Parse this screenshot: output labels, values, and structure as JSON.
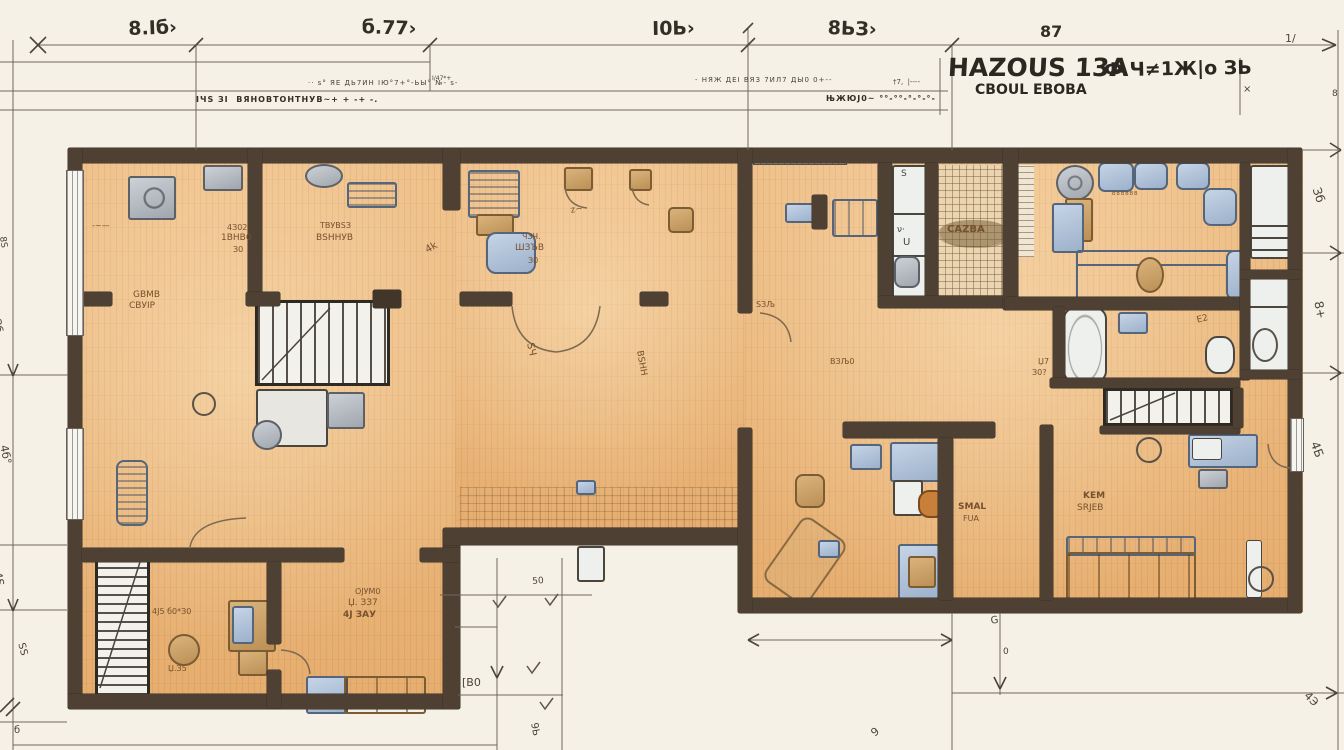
{
  "title_block": {
    "title": "HAZOUS 13A",
    "subtitle": "CBOUL EBOBA",
    "side_text": "Ф Ч≠1Ж|о ЗЬ"
  },
  "colors": {
    "paper": "#f5f1e6",
    "wall": "#4e4133",
    "floor": "#ecba80",
    "furniture_blue": "#a9bdd4",
    "furniture_tan": "#c9a06a",
    "fixture_white": "#eef0ee",
    "accent_orange": "#c87f3a"
  },
  "annotations": [
    {
      "n": "dim-top-1",
      "t": "8.Іб›",
      "x": 128,
      "y": 20,
      "s": 19,
      "r": -2,
      "c": "ink",
      "w": 700
    },
    {
      "n": "dim-top-2",
      "t": "б.77›",
      "x": 362,
      "y": 18,
      "s": 19,
      "r": 2,
      "c": "ink",
      "w": 700
    },
    {
      "n": "dim-top-3",
      "t": "І0Ь›",
      "x": 652,
      "y": 20,
      "s": 19,
      "r": -1,
      "c": "ink",
      "w": 700
    },
    {
      "n": "dim-top-4",
      "t": "8ЬЗ›",
      "x": 828,
      "y": 19,
      "s": 19,
      "r": 2,
      "c": "ink",
      "w": 700
    },
    {
      "n": "dim-top-5",
      "t": "87",
      "x": 1040,
      "y": 24,
      "s": 16,
      "c": "ink",
      "w": 700
    },
    {
      "n": "schedule-row-1",
      "t": "·· ѕ° ЯЕ ДЬ7ИН ІЮ°7+°-ЬЫ° №- ѕ-",
      "x": 308,
      "y": 80,
      "s": 7,
      "c": "dim",
      "ls": 1
    },
    {
      "n": "schedule-row-2",
      "t": "ІЧЅ ЗІ  ВЯНОВТОНТНУВ~+ + -+ -.",
      "x": 196,
      "y": 96,
      "s": 8,
      "c": "ink",
      "w": 700,
      "ls": 1
    },
    {
      "n": "schedule-row-3",
      "t": "- НЯЖ ДЕІ ВЯЗ 7ИЛ7 ДЫ0 0+--",
      "x": 695,
      "y": 77,
      "s": 7,
      "c": "dim",
      "ls": 1
    },
    {
      "n": "schedule-row-4",
      "t": "ЊЖЮЈ0~ °°-°°-°-°-°-",
      "x": 826,
      "y": 95,
      "s": 8,
      "c": "ink",
      "w": 700,
      "ls": 1
    },
    {
      "n": "schedule-row-5",
      "t": "†7,  |----",
      "x": 893,
      "y": 79,
      "s": 7,
      "c": "dim"
    },
    {
      "n": "schedule-row-6",
      "t": "І/47*+",
      "x": 432,
      "y": 76,
      "s": 6,
      "c": "dim"
    },
    {
      "n": "dim-left-1",
      "t": "8Ѕ",
      "x": 6,
      "y": 236,
      "s": 9,
      "r": 82,
      "c": "dim"
    },
    {
      "n": "dim-left-2",
      "t": "Зб",
      "x": 2,
      "y": 318,
      "s": 11,
      "r": 80,
      "c": "dim"
    },
    {
      "n": "dim-left-3",
      "t": "4б°",
      "x": 9,
      "y": 444,
      "s": 11,
      "r": 78,
      "c": "dim"
    },
    {
      "n": "dim-left-4",
      "t": "4Ѕ",
      "x": 3,
      "y": 571,
      "s": 11,
      "r": 80,
      "c": "dim"
    },
    {
      "n": "dim-left-5",
      "t": "ЅЅ",
      "x": 25,
      "y": 642,
      "s": 10,
      "r": 75,
      "c": "dim"
    },
    {
      "n": "dim-left-6",
      "t": "б",
      "x": 14,
      "y": 726,
      "s": 10,
      "c": "dim"
    },
    {
      "n": "dim-right-1",
      "t": "1/",
      "x": 1285,
      "y": 33,
      "s": 11,
      "c": "dim"
    },
    {
      "n": "dim-right-2",
      "t": "8",
      "x": 1332,
      "y": 90,
      "s": 9,
      "c": "dim"
    },
    {
      "n": "dim-right-3",
      "t": "×",
      "x": 1243,
      "y": 85,
      "s": 10,
      "c": "dim"
    },
    {
      "n": "dim-right-4",
      "t": "Зб",
      "x": 1322,
      "y": 186,
      "s": 12,
      "r": 72,
      "c": "dim"
    },
    {
      "n": "dim-right-5",
      "t": "8+",
      "x": 1324,
      "y": 300,
      "s": 12,
      "r": 78,
      "c": "dim"
    },
    {
      "n": "dim-right-6",
      "t": "4Б",
      "x": 1320,
      "y": 440,
      "s": 12,
      "r": 70,
      "c": "dim"
    },
    {
      "n": "dim-right-7",
      "t": "4Э",
      "x": 1310,
      "y": 690,
      "s": 11,
      "r": 45,
      "c": "dim"
    },
    {
      "n": "dim-bottom-1",
      "t": "50",
      "x": 532,
      "y": 578,
      "s": 9,
      "r": -5,
      "c": "dim"
    },
    {
      "n": "dim-bottom-2",
      "t": "[В0",
      "x": 462,
      "y": 677,
      "s": 11,
      "c": "dim"
    },
    {
      "n": "dim-bottom-3",
      "t": "9Ь",
      "x": 538,
      "y": 722,
      "s": 10,
      "r": 80,
      "c": "dim"
    },
    {
      "n": "dim-bottom-4",
      "t": "G",
      "x": 990,
      "y": 617,
      "s": 10,
      "r": -10,
      "c": "dim"
    },
    {
      "n": "dim-bottom-5",
      "t": "0",
      "x": 1003,
      "y": 648,
      "s": 9,
      "c": "dim"
    },
    {
      "n": "dim-bottom-6",
      "t": "9",
      "x": 869,
      "y": 730,
      "s": 11,
      "r": -40,
      "c": "dim"
    },
    {
      "n": "room-label-1a",
      "t": "GВМВ",
      "x": 133,
      "y": 291,
      "s": 9,
      "c": "pencil"
    },
    {
      "n": "room-label-1b",
      "t": "СВУІР",
      "x": 129,
      "y": 302,
      "s": 9,
      "c": "pencil"
    },
    {
      "n": "room-label-2a",
      "t": "4З02",
      "x": 227,
      "y": 224,
      "s": 8,
      "c": "pencil"
    },
    {
      "n": "room-label-2b",
      "t": "1ВНВ0",
      "x": 221,
      "y": 234,
      "s": 9,
      "c": "pencil"
    },
    {
      "n": "room-label-2c",
      "t": "З0",
      "x": 233,
      "y": 246,
      "s": 8,
      "c": "pencil"
    },
    {
      "n": "room-label-3a",
      "t": "ТВУВЅЗ",
      "x": 320,
      "y": 222,
      "s": 8,
      "c": "pencil"
    },
    {
      "n": "room-label-3b",
      "t": "ВЅННУВ",
      "x": 316,
      "y": 234,
      "s": 9,
      "c": "pencil"
    },
    {
      "n": "room-label-4a",
      "t": "ЧЗЧ.",
      "x": 522,
      "y": 233,
      "s": 8,
      "c": "pencil"
    },
    {
      "n": "room-label-4b",
      "t": "ШЗЪВ",
      "x": 515,
      "y": 244,
      "s": 9,
      "c": "pencil"
    },
    {
      "n": "room-label-4c",
      "t": "З0",
      "x": 528,
      "y": 257,
      "s": 8,
      "c": "pencil"
    },
    {
      "n": "room-label-5",
      "t": "ЅЧ",
      "x": 534,
      "y": 342,
      "s": 10,
      "r": 78,
      "c": "pencil"
    },
    {
      "n": "room-label-6",
      "t": "ВЅНН",
      "x": 643,
      "y": 350,
      "s": 9,
      "r": 80,
      "c": "pencil"
    },
    {
      "n": "room-label-7",
      "t": "ЅЗЉ",
      "x": 756,
      "y": 301,
      "s": 8,
      "c": "pencil"
    },
    {
      "n": "room-label-8",
      "t": "ВЗЉ0",
      "x": 830,
      "y": 358,
      "s": 8,
      "c": "pencil"
    },
    {
      "n": "room-label-9a",
      "t": "SMAL",
      "x": 958,
      "y": 503,
      "s": 9,
      "w": 700,
      "c": "pencil"
    },
    {
      "n": "room-label-9b",
      "t": "FUA",
      "x": 963,
      "y": 515,
      "s": 8,
      "c": "pencil"
    },
    {
      "n": "room-label-10a",
      "t": "KEM",
      "x": 1083,
      "y": 492,
      "s": 9,
      "w": 700,
      "c": "pencil"
    },
    {
      "n": "room-label-10b",
      "t": "SRJEB",
      "x": 1077,
      "y": 504,
      "s": 9,
      "c": "pencil"
    },
    {
      "n": "room-label-11a",
      "t": "Џ7",
      "x": 1038,
      "y": 358,
      "s": 8,
      "c": "pencil"
    },
    {
      "n": "room-label-11b",
      "t": "З0?",
      "x": 1032,
      "y": 369,
      "s": 8,
      "c": "pencil"
    },
    {
      "n": "room-label-12",
      "t": "ВВВВВВ",
      "x": 1112,
      "y": 192,
      "s": 5,
      "ls": 1,
      "c": "pencil"
    },
    {
      "n": "room-label-13",
      "t": "E2",
      "x": 1196,
      "y": 317,
      "s": 9,
      "r": -15,
      "c": "pencil"
    },
    {
      "n": "room-label-14",
      "t": "4Ј5 б0*З0",
      "x": 152,
      "y": 608,
      "s": 8,
      "c": "pencil"
    },
    {
      "n": "room-label-15",
      "t": "Џ.З5",
      "x": 168,
      "y": 665,
      "s": 8,
      "c": "pencil"
    },
    {
      "n": "room-label-16a",
      "t": "ОЈУМ0",
      "x": 355,
      "y": 588,
      "s": 8,
      "c": "pencil"
    },
    {
      "n": "room-label-16b",
      "t": "Џ. ЗЗ7",
      "x": 348,
      "y": 599,
      "s": 9,
      "c": "pencil"
    },
    {
      "n": "room-label-16c",
      "t": "4Ј ЗАУ",
      "x": 343,
      "y": 611,
      "s": 9,
      "w": 700,
      "c": "pencil"
    },
    {
      "n": "room-label-17",
      "t": "CAZBA",
      "x": 947,
      "y": 225,
      "s": 10,
      "w": 700,
      "c": "pencil"
    },
    {
      "n": "room-label-18",
      "t": "-~—",
      "x": 92,
      "y": 222,
      "s": 8,
      "c": "pencil"
    },
    {
      "n": "room-label-19",
      "t": "z~",
      "x": 570,
      "y": 207,
      "s": 9,
      "r": -10,
      "c": "pencil"
    },
    {
      "n": "room-label-20",
      "t": "4k",
      "x": 424,
      "y": 247,
      "s": 10,
      "r": -30,
      "c": "pencil"
    },
    {
      "n": "fixture-glyph-1",
      "t": "Ѕ",
      "x": 901,
      "y": 170,
      "s": 9,
      "c": "dim"
    },
    {
      "n": "fixture-glyph-2",
      "t": "ν·",
      "x": 897,
      "y": 226,
      "s": 9,
      "c": "dim"
    },
    {
      "n": "fixture-glyph-3",
      "t": "U",
      "x": 903,
      "y": 238,
      "s": 10,
      "c": "dim"
    }
  ]
}
